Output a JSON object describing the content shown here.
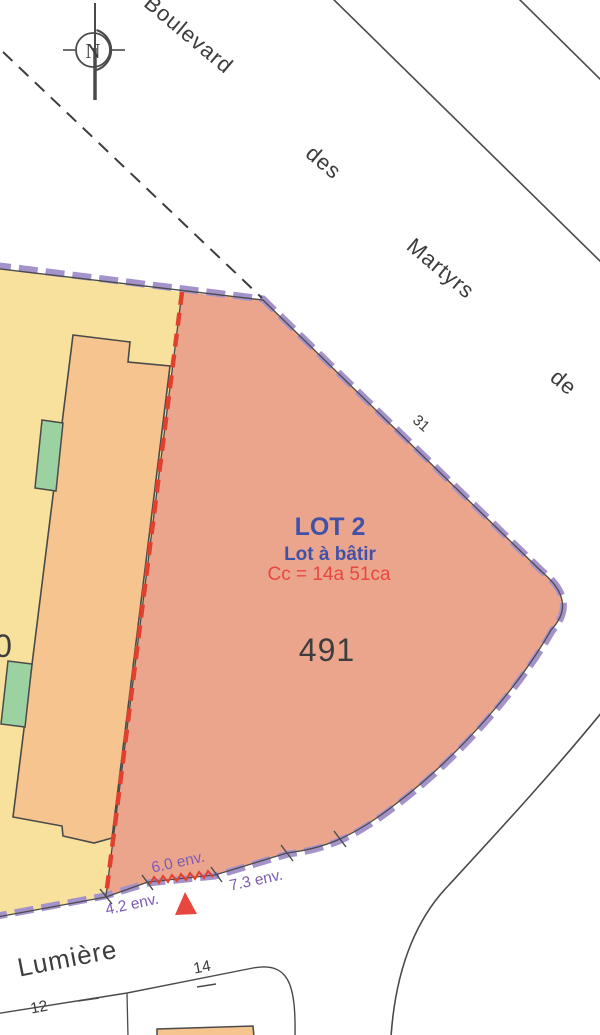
{
  "map": {
    "compass_north": "N",
    "street_top": {
      "w1": "Boulevard",
      "w2": "des",
      "w3": "Martyrs",
      "w4": "de"
    },
    "street_top_number": "31",
    "street_bottom": "Lumière",
    "house_number_12": "12",
    "house_number_14": "14",
    "lot": {
      "title": "LOT 2",
      "subtitle": "Lot à bâtir",
      "area_label": "Cc = 14a 51ca",
      "parcel_number": "491"
    },
    "adjacent_parcel_digit": "0",
    "measurements": {
      "m42": "4.2 env.",
      "m60": "6.0 env.",
      "m73": "7.3 env."
    }
  },
  "colors": {
    "parcel_yellow": "#f7e19c",
    "building_orange": "#f5c48f",
    "lot_salmon": "#eca58d",
    "green_annex": "#9cd2a2",
    "boundary_purple": "#a492cb",
    "division_red": "#e2402f",
    "label_blue": "#4052a8",
    "label_red": "#e8473f",
    "measure_purple": "#7d5ab5",
    "line_gray": "#4a4a4a",
    "text_gray": "#3d3d3d",
    "white": "#ffffff"
  }
}
